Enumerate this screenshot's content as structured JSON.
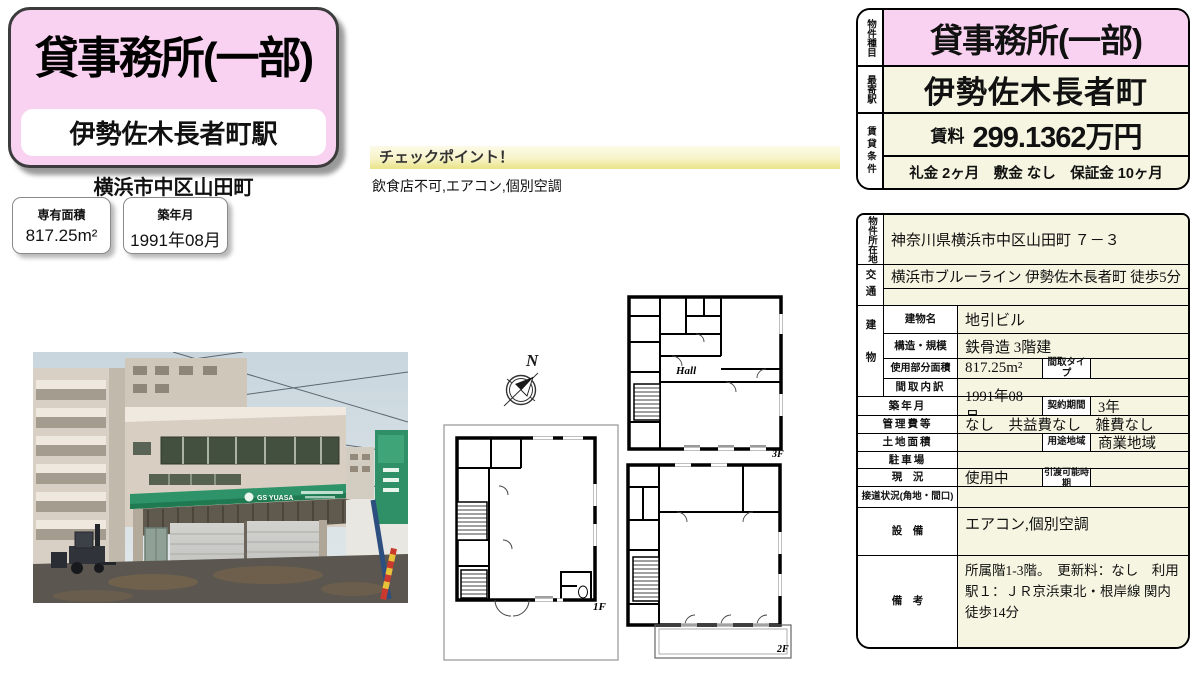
{
  "header": {
    "property_type": "貸事務所(一部)",
    "station": "伊勢佐木長者町駅",
    "address_short": "横浜市中区山田町",
    "badges": [
      {
        "label": "専有面積",
        "value": "817.25m²"
      },
      {
        "label": "築年月",
        "value": "1991年08月"
      }
    ]
  },
  "checkpoint": {
    "title": "チェックポイント！",
    "items": "飲食店不可,エアコン,個別空調"
  },
  "photo": {
    "sign_text": "GS YUASA"
  },
  "floorplan": {
    "north": "N",
    "hall": "Hall",
    "f1": "1F",
    "f2": "2F",
    "f3": "3F"
  },
  "summary": {
    "type_label": "物件種目",
    "type_value": "貸事務所(一部)",
    "station_label": "最寄駅",
    "station_value": "伊勢佐木長者町",
    "cond_label": "賃貸条件",
    "rent_label": "賃料",
    "rent_value": "299.1362万円",
    "terms": "礼金 2ヶ月　敷金 なし　保証金 10ヶ月"
  },
  "detail": {
    "location_label": "物件所在地",
    "location": "神奈川県横浜市中区山田町 ７－３",
    "access_label": "交通",
    "access": "横浜市ブルーライン 伊勢佐木長者町 徒歩5分",
    "access_line2": "",
    "building_label": "建物",
    "building_name_label": "建物名",
    "building_name": "地引ビル",
    "structure_label": "構造・規模",
    "structure": "鉄骨造 3階建",
    "used_area_label": "使用部分面積",
    "used_area": "817.25m²",
    "madori_type_label": "間取タイプ",
    "madori_type": "",
    "madori_detail_label": "間取内訳",
    "madori_detail": "",
    "built_label": "築年月",
    "built": "1991年08月",
    "contract_label": "契約期間",
    "contract": "3年",
    "fees_label": "管理費等",
    "fees": "なし　共益費なし　雑費なし",
    "land_label": "土地面積",
    "land": "",
    "zoning_label": "用途地域",
    "zoning": "商業地域",
    "parking_label": "駐車場",
    "parking": "",
    "status_label": "現　況",
    "status": "使用中",
    "handover_label": "引渡可能時期",
    "handover": "",
    "road_label": "接道状況(角地・間口)",
    "road": "",
    "equipment_label": "設　備",
    "equipment": "エアコン,個別空調",
    "notes_label": "備　考",
    "notes": "所属階1-3階。　更新料：なし　利用駅１：ＪＲ京浜東北・根岸線 関内 徒歩14分"
  },
  "colors": {
    "pink": "#f8d2f0",
    "cream": "#f5f5e1",
    "canopy_green": "#2e9368",
    "checkpoint_yellow": "#e9e387"
  }
}
